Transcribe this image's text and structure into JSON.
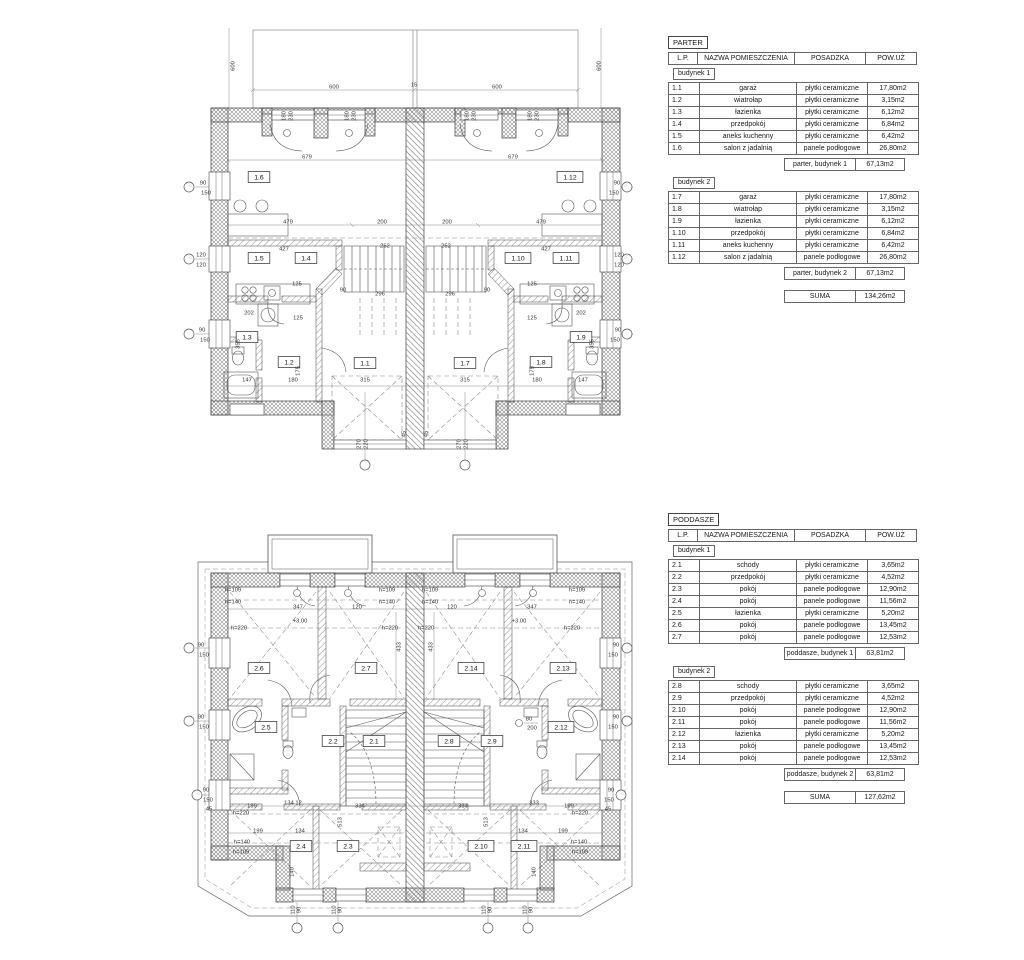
{
  "sheet": {
    "background": "#ffffff",
    "line_color": "#444444"
  },
  "tables": [
    {
      "title": "PARTER",
      "headers": [
        "L.P.",
        "NAZWA POMIESZCZENIA",
        "POSADZKA",
        "POW.UŻ"
      ],
      "groups": [
        {
          "label": "budynek 1",
          "rows": [
            [
              "1.1",
              "garaż",
              "płytki ceramiczne",
              "17,80m2"
            ],
            [
              "1.2",
              "wiatrołap",
              "płytki ceramiczne",
              "3,15m2"
            ],
            [
              "1.3",
              "łazienka",
              "płytki ceramiczne",
              "6,12m2"
            ],
            [
              "1.4",
              "przedpokój",
              "płytki ceramiczne",
              "6,84m2"
            ],
            [
              "1.5",
              "aneks kuchenny",
              "płytki ceramiczne",
              "6,42m2"
            ],
            [
              "1.6",
              "salon z jadalnią",
              "panele podłogowe",
              "26,80m2"
            ]
          ],
          "subtotal": [
            "parter, budynek 1",
            "67,13m2"
          ]
        },
        {
          "label": "budynek 2",
          "rows": [
            [
              "1.7",
              "garaż",
              "płytki ceramiczne",
              "17,80m2"
            ],
            [
              "1.8",
              "wiatrołap",
              "płytki ceramiczne",
              "3,15m2"
            ],
            [
              "1.9",
              "łazienka",
              "płytki ceramiczne",
              "6,12m2"
            ],
            [
              "1.10",
              "przedpokój",
              "płytki ceramiczne",
              "6,84m2"
            ],
            [
              "1.11",
              "aneks kuchenny",
              "płytki ceramiczne",
              "6,42m2"
            ],
            [
              "1.12",
              "salon z jadalnią",
              "panele podłogowe",
              "26,80m2"
            ]
          ],
          "subtotal": [
            "parter, budynek 2",
            "67,13m2"
          ]
        }
      ],
      "total": [
        "SUMA",
        "134,26m2"
      ]
    },
    {
      "title": "PODDASZE",
      "headers": [
        "L.P.",
        "NAZWA POMIESZCZENIA",
        "POSADZKA",
        "POW.UŻ"
      ],
      "groups": [
        {
          "label": "budynek 1",
          "rows": [
            [
              "2.1",
              "schody",
              "płytki ceramiczne",
              "3,65m2"
            ],
            [
              "2.2",
              "przedpokój",
              "płytki ceramiczne",
              "4,52m2"
            ],
            [
              "2.3",
              "pokój",
              "panele podłogowe",
              "12,90m2"
            ],
            [
              "2.4",
              "pokój",
              "panele podłogowe",
              "11,56m2"
            ],
            [
              "2.5",
              "łazienka",
              "płytki ceramiczne",
              "5,20m2"
            ],
            [
              "2.6",
              "pokój",
              "panele podłogowe",
              "13,45m2"
            ],
            [
              "2.7",
              "pokój",
              "panele podłogowe",
              "12,53m2"
            ]
          ],
          "subtotal": [
            "poddasze, budynek 1",
            "63,81m2"
          ]
        },
        {
          "label": "budynek 2",
          "rows": [
            [
              "2.8",
              "schody",
              "płytki ceramiczne",
              "3,65m2"
            ],
            [
              "2.9",
              "przedpokój",
              "płytki ceramiczne",
              "4,52m2"
            ],
            [
              "2.10",
              "pokój",
              "panele podłogowe",
              "12,90m2"
            ],
            [
              "2.11",
              "pokój",
              "panele podłogowe",
              "11,56m2"
            ],
            [
              "2.12",
              "łazienka",
              "płytki ceramiczne",
              "5,20m2"
            ],
            [
              "2.13",
              "pokój",
              "panele podłogowe",
              "13,45m2"
            ],
            [
              "2.14",
              "pokój",
              "panele podłogowe",
              "12,53m2"
            ]
          ],
          "subtotal": [
            "poddasze, budynek 2",
            "63,81m2"
          ]
        }
      ],
      "total": [
        "SUMA",
        "127,62m2"
      ]
    }
  ],
  "plans": [
    {
      "name": "parter-plan",
      "rooms": [
        [
          "1.6",
          259,
          177
        ],
        [
          "1.12",
          570,
          177
        ],
        [
          "1.5",
          259,
          258
        ],
        [
          "1.4",
          306,
          258
        ],
        [
          "1.10",
          518,
          258
        ],
        [
          "1.11",
          566,
          258
        ],
        [
          "1.3",
          247,
          337
        ],
        [
          "1.9",
          581,
          337
        ],
        [
          "1.2",
          289,
          362
        ],
        [
          "1.8",
          541,
          362
        ],
        [
          "1.1",
          365,
          363
        ],
        [
          "1.7",
          465,
          363
        ]
      ],
      "dims": [
        [
          "600",
          334,
          87
        ],
        [
          "15",
          414,
          85
        ],
        [
          "600",
          497,
          87
        ],
        [
          "600",
          233,
          66,
          1
        ],
        [
          "600",
          599,
          66,
          1
        ],
        [
          "180",
          284,
          116,
          1
        ],
        [
          "230",
          291,
          116,
          1
        ],
        [
          "180",
          347,
          116,
          1
        ],
        [
          "230",
          354,
          116,
          1
        ],
        [
          "180",
          467,
          116,
          1
        ],
        [
          "230",
          474,
          116,
          1
        ],
        [
          "180",
          530,
          116,
          1
        ],
        [
          "230",
          537,
          116,
          1
        ],
        [
          "679",
          307,
          157
        ],
        [
          "679",
          513,
          157
        ],
        [
          "90",
          203,
          183
        ],
        [
          "150",
          206,
          193
        ],
        [
          "120",
          201,
          255
        ],
        [
          "120",
          201,
          265
        ],
        [
          "90",
          202,
          330
        ],
        [
          "150",
          205,
          340
        ],
        [
          "90",
          617,
          183
        ],
        [
          "150",
          614,
          193
        ],
        [
          "120",
          619,
          255
        ],
        [
          "120",
          619,
          265
        ],
        [
          "90",
          618,
          330
        ],
        [
          "150",
          615,
          340
        ],
        [
          "479",
          288,
          222
        ],
        [
          "200",
          382,
          222
        ],
        [
          "200",
          447,
          222
        ],
        [
          "479",
          541,
          222
        ],
        [
          "427",
          284,
          249
        ],
        [
          "427",
          546,
          249
        ],
        [
          "252",
          385,
          246
        ],
        [
          "252",
          446,
          246
        ],
        [
          "125",
          297,
          284
        ],
        [
          "90",
          343,
          290
        ],
        [
          "125",
          532,
          284
        ],
        [
          "90",
          487,
          290
        ],
        [
          "296",
          380,
          294
        ],
        [
          "296",
          450,
          294
        ],
        [
          "202",
          249,
          313
        ],
        [
          "202",
          581,
          313
        ],
        [
          "125",
          298,
          318
        ],
        [
          "125",
          532,
          318
        ],
        [
          "355",
          238,
          344,
          1
        ],
        [
          "355",
          592,
          344,
          1
        ],
        [
          "175",
          298,
          371,
          1
        ],
        [
          "175",
          532,
          371,
          1
        ],
        [
          "147",
          247,
          380
        ],
        [
          "180",
          293,
          380
        ],
        [
          "315",
          365,
          380
        ],
        [
          "315",
          465,
          380
        ],
        [
          "180",
          537,
          380
        ],
        [
          "147",
          583,
          380
        ],
        [
          "270",
          359,
          444,
          1
        ],
        [
          "220",
          366,
          444,
          1
        ],
        [
          "270",
          459,
          444,
          1
        ],
        [
          "220",
          466,
          444,
          1
        ],
        [
          "45",
          404,
          434,
          1
        ],
        [
          "45",
          426,
          434,
          1
        ]
      ],
      "circles": [
        [
          189,
          187
        ],
        [
          189,
          259
        ],
        [
          189,
          334
        ],
        [
          627,
          187
        ],
        [
          627,
          259
        ],
        [
          627,
          334
        ],
        [
          365,
          465
        ],
        [
          465,
          465
        ]
      ],
      "circles_sm": [
        [
          287,
          133
        ],
        [
          349,
          133
        ],
        [
          477,
          133
        ],
        [
          539,
          133
        ]
      ]
    },
    {
      "name": "poddasze-plan",
      "rooms": [
        [
          "2.6",
          259,
          668
        ],
        [
          "2.7",
          366,
          668
        ],
        [
          "2.14",
          471,
          668
        ],
        [
          "2.13",
          563,
          668
        ],
        [
          "2.5",
          266,
          727
        ],
        [
          "2.2",
          333,
          741
        ],
        [
          "2.1",
          374,
          741
        ],
        [
          "2.8",
          449,
          741
        ],
        [
          "2.9",
          492,
          741
        ],
        [
          "2.12",
          561,
          727
        ],
        [
          "2.4",
          301,
          846
        ],
        [
          "2.3",
          348,
          846
        ],
        [
          "2.10",
          481,
          846
        ],
        [
          "2.11",
          524,
          846
        ]
      ],
      "dims": [
        [
          "347",
          298,
          607
        ],
        [
          "120",
          357,
          607
        ],
        [
          "120",
          452,
          607
        ],
        [
          "347",
          532,
          607
        ],
        [
          "h=109",
          233,
          590
        ],
        [
          "h=140",
          233,
          602
        ],
        [
          "h=220",
          239,
          628
        ],
        [
          "h=109",
          387,
          590
        ],
        [
          "h=140",
          387,
          602
        ],
        [
          "h=220",
          390,
          628
        ],
        [
          "h=109",
          430,
          590
        ],
        [
          "h=140",
          430,
          602
        ],
        [
          "h=220",
          426,
          628
        ],
        [
          "h=109",
          577,
          590
        ],
        [
          "h=140",
          577,
          602
        ],
        [
          "h=220",
          572,
          628
        ],
        [
          "+3.00",
          300,
          621
        ],
        [
          "+3.00",
          519,
          621
        ],
        [
          "433",
          399,
          647,
          1
        ],
        [
          "433",
          431,
          647,
          1
        ],
        [
          "90",
          201,
          645
        ],
        [
          "150",
          204,
          655
        ],
        [
          "90",
          616,
          645
        ],
        [
          "150",
          613,
          655
        ],
        [
          "90",
          201,
          717
        ],
        [
          "150",
          204,
          727
        ],
        [
          "90",
          616,
          717
        ],
        [
          "150",
          613,
          727
        ],
        [
          "90",
          206,
          790
        ],
        [
          "150",
          208,
          800
        ],
        [
          "45",
          209,
          809
        ],
        [
          "90",
          611,
          790
        ],
        [
          "150",
          609,
          800
        ],
        [
          "45",
          608,
          809
        ],
        [
          "h=220",
          241,
          813
        ],
        [
          "h=140",
          242,
          842
        ],
        [
          "h=109",
          241,
          852
        ],
        [
          "h=220",
          580,
          813
        ],
        [
          "h=140",
          579,
          842
        ],
        [
          "h=109",
          580,
          852
        ],
        [
          "199",
          252,
          806
        ],
        [
          "134 12",
          293,
          803
        ],
        [
          "334",
          360,
          806
        ],
        [
          "334",
          463,
          806
        ],
        [
          "333",
          534,
          803
        ],
        [
          "199",
          569,
          806
        ],
        [
          "199",
          258,
          831
        ],
        [
          "134",
          300,
          831
        ],
        [
          "134",
          523,
          831
        ],
        [
          "199",
          563,
          831
        ],
        [
          "513",
          340,
          822,
          1
        ],
        [
          "513",
          486,
          822,
          1
        ],
        [
          "140",
          292,
          872,
          1
        ],
        [
          "140",
          534,
          872,
          1
        ],
        [
          "80",
          529,
          719
        ],
        [
          "200",
          532,
          728
        ],
        [
          "110",
          293,
          910,
          1
        ],
        [
          "90",
          299,
          910,
          1
        ],
        [
          "110",
          334,
          910,
          1
        ],
        [
          "90",
          340,
          910,
          1
        ],
        [
          "110",
          484,
          910,
          1
        ],
        [
          "90",
          490,
          910,
          1
        ],
        [
          "110",
          525,
          910,
          1
        ],
        [
          "90",
          531,
          910,
          1
        ]
      ],
      "circles": [
        [
          189,
          648
        ],
        [
          189,
          721
        ],
        [
          197,
          795
        ],
        [
          627,
          648
        ],
        [
          627,
          721
        ],
        [
          621,
          795
        ],
        [
          297,
          928
        ],
        [
          338,
          928
        ],
        [
          488,
          928
        ],
        [
          528,
          928
        ]
      ],
      "circles_sm": [
        [
          297,
          593
        ],
        [
          348,
          593
        ],
        [
          482,
          593
        ],
        [
          533,
          593
        ],
        [
          519,
          723
        ]
      ]
    }
  ]
}
